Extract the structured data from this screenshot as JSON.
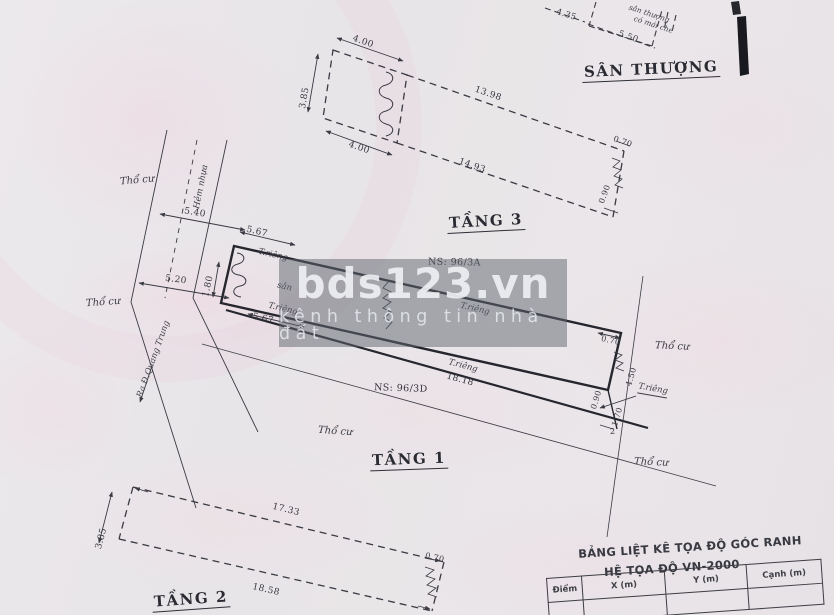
{
  "watermark": {
    "brand": "bds123.vn",
    "tagline": "kênh thông tin nhà đất"
  },
  "floor_labels": {
    "san_thuong": "SÂN THƯỢNG",
    "tang3": "TẦNG 3",
    "tang1": "TẦNG 1",
    "tang2": "TẦNG 2"
  },
  "parcel_ids": {
    "upper": "NS: 96/3A",
    "lower": "NS: 96/3D"
  },
  "land_labels": {
    "tho_cu": "Thổ cư",
    "t_rieng": "T.riêng",
    "san": "sân",
    "hem_nhua": "Hẻm nhựa",
    "road_exit": "Ra Đ.Quang Trung",
    "roof_note_1": "sân thượng",
    "roof_note_2": "có mái che",
    "point_2": "2"
  },
  "dims": {
    "st_top": "4.00",
    "st_left": "3.85",
    "st_bottom": "4.00",
    "st_len_top": "13.98",
    "st_len_bot": "14.93",
    "st_end_top": "0.70",
    "st_end_bot": "0.90",
    "roof_box_left": "4.35",
    "roof_box_bottom": "5.50",
    "road_upper": "5.40",
    "road_lower": "5.20",
    "p_front_top": "5.67",
    "p_front_left": "1.80",
    "p_front_bottom": "5.67",
    "p_len_lower": "18.18",
    "p_end_step": "0.70",
    "p_end_a": "0.90",
    "p_end_b": "1.70",
    "p_end_c": "4.50",
    "t2_left": "3.85",
    "t2_top": "17.33",
    "t2_bottom": "18.58",
    "t2_end": "0.70"
  },
  "coord_table": {
    "title_line1": "BẢNG LIỆT KÊ TỌA ĐỘ GÓC RANH",
    "title_line2": "HỆ TỌA ĐỘ VN-2000",
    "headers": [
      "Điểm",
      "X (m)",
      "Y (m)",
      "Cạnh (m)"
    ]
  },
  "colors": {
    "paper": "#e8e5e8",
    "ink": "#3a3a43",
    "bold_ink": "#26262e",
    "watermark_band": "rgba(96,101,110,0.5)",
    "pink_tint": "#f1dde6"
  }
}
